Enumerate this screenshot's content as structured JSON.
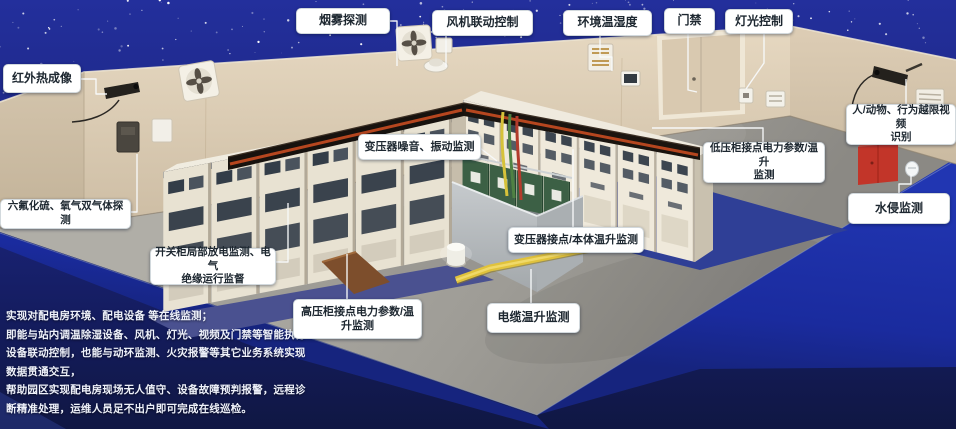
{
  "callouts": [
    {
      "id": "smoke-detection",
      "text": "烟雾探测"
    },
    {
      "id": "fan-linkage-control",
      "text": "风机联动控制"
    },
    {
      "id": "env-temp-humidity",
      "text": "环境温湿度"
    },
    {
      "id": "door-access",
      "text": "门禁"
    },
    {
      "id": "light-control",
      "text": "灯光控制"
    },
    {
      "id": "infrared-thermal-imaging",
      "text": "红外热成像"
    },
    {
      "id": "sf6-o2-gas-detection",
      "text": "六氟化硫、氧气双气体探测"
    },
    {
      "id": "intrusion-video-recognition",
      "text": "人/动物、行为越限视频\n识别"
    },
    {
      "id": "water-intrusion-monitoring",
      "text": "水侵监测"
    },
    {
      "id": "transformer-noise-vibration",
      "text": "变压器噪音、振动监测"
    },
    {
      "id": "lv-cabinet-power-temp",
      "text": "低压柜接点电力参数/温升\n监测"
    },
    {
      "id": "transformer-joint-body-temp",
      "text": "变压器接点/本体温升监测"
    },
    {
      "id": "switchgear-partial-discharge",
      "text": "开关柜局部放电监测、电气\n绝缘运行监督"
    },
    {
      "id": "hv-cabinet-power-temp",
      "text": "高压柜接点电力参数/温\n升监测"
    },
    {
      "id": "cable-temp-rise",
      "text": "电缆温升监测"
    }
  ],
  "intro_text": "实现对配电房环境、配电设备 等在线监测；\n即能与站内调温除湿设备、风机、灯光、视频及门禁等智能执行\n设备联动控制，也能与动环监测、火灾报警等其它业务系统实现\n数据贯通交互，\n帮助园区实现配电房现场无人值守、设备故障预判报警，远程诊\n断精准处理，运维人员足不出户即可完成在线巡检。",
  "colors": {
    "sky_blue": "#212d96",
    "background_navy": "#121a50",
    "apron_blue": "#1d2fa4",
    "wall_beige": "#d8c9b2",
    "floor_gray": "#a19f9a",
    "equipment_mat_blue": "#33408f",
    "transformer_green": "#3c6045",
    "alarm_red": "#c13528",
    "cable_yellow": "#d6c23a",
    "cable_green": "#4f8243",
    "cable_red": "#b33b2c"
  }
}
